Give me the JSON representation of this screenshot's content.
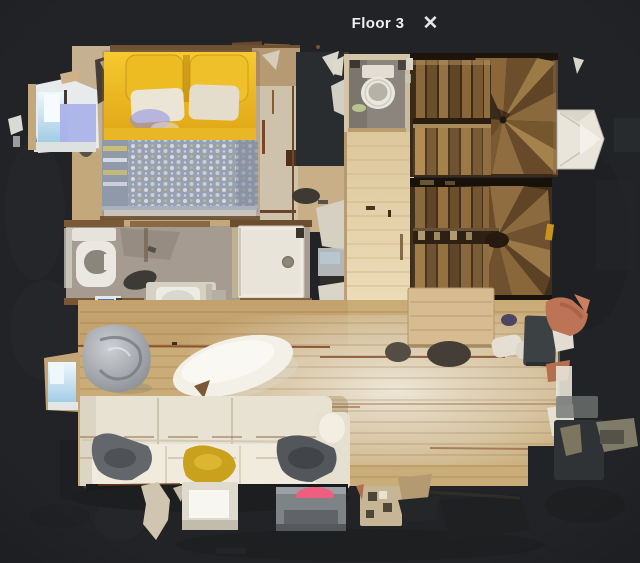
{
  "header": {
    "floor_label": "Floor 3",
    "close_icon": "✕"
  },
  "palette": {
    "background": "#212326",
    "header_text": "#edeff0",
    "bed_duvet_yellow": "#e9b724",
    "bed_blanket_blue": "#97a1b2",
    "stair_wood_brown": "#8a6a3e",
    "living_floor_wood": "#c9ac78",
    "sofa_cream": "#e8e2d2",
    "sheepskin_rug_white": "#f3f0e7",
    "bathroom_floor_gray": "#a59b91",
    "pink_accent": "#ee5e7e"
  }
}
